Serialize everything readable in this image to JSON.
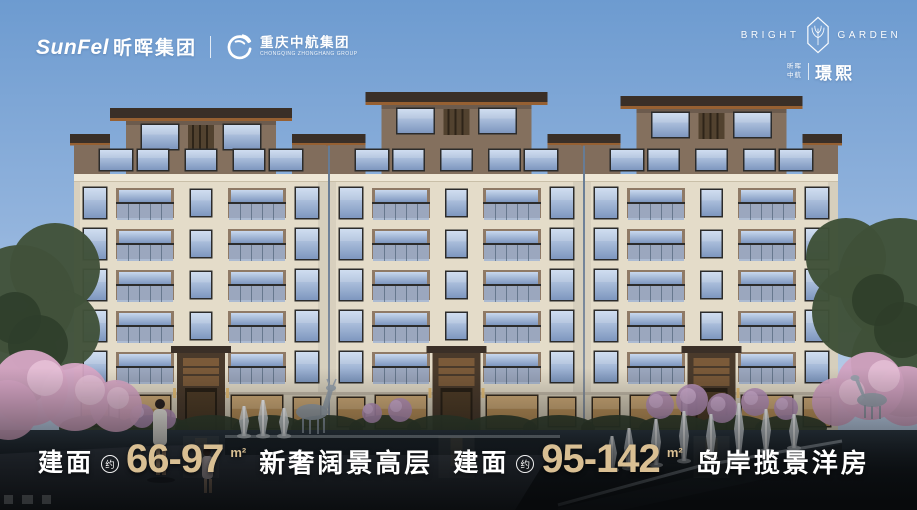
{
  "header": {
    "sunfel_en": "SunFel",
    "sunfel_cn": "昕晖集团",
    "partner_cn": "重庆中航集团",
    "partner_en": "CHONGQING ZHONGHANG GROUP"
  },
  "brand": {
    "en_left": "BRIGHT",
    "en_right": "GARDEN",
    "cn_small_top": "昕晖",
    "cn_small_bottom": "中航",
    "cn_name": "璟熙"
  },
  "tagline": {
    "left": {
      "label": "建面",
      "approx": "约",
      "range": "66-97",
      "unit": "m²",
      "slogan": "新奢阔景高层"
    },
    "right": {
      "label": "建面",
      "approx": "约",
      "range": "95-142",
      "unit": "m²",
      "slogan": "岛岸揽景洋房"
    }
  },
  "colors": {
    "number_gold": "#d9bf93",
    "accent_orange": "#e89a3c",
    "sky_top": "#6d9bd0",
    "sky_bottom": "#ccd9ec",
    "roof_dark": "#3a2f27",
    "facade_cream": "#e4dcc9",
    "penthouse_brown": "#84705e",
    "glass_blue": "#8fa8cc",
    "blossom_pink": "#d8a8c6",
    "water_dark": "#0b0d0f"
  }
}
